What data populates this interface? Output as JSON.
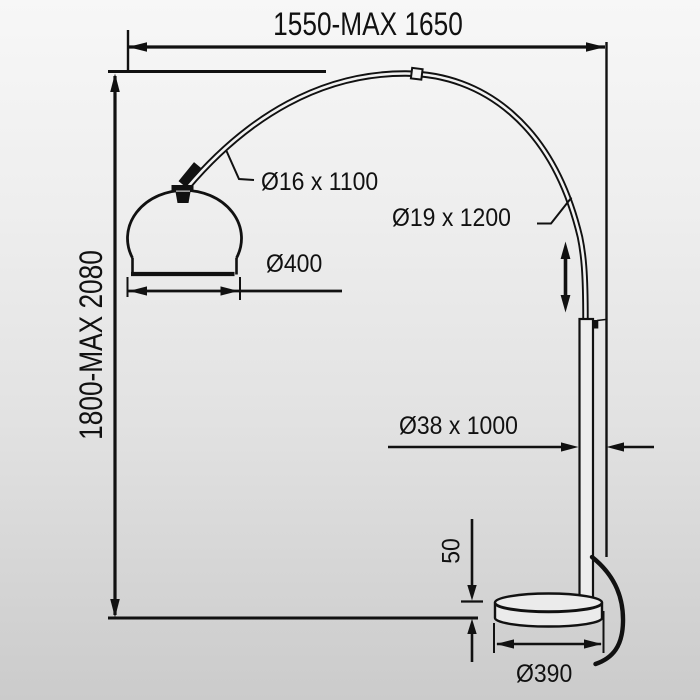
{
  "diagram": {
    "kind": "technical-dimension-drawing",
    "subject": "arc floor lamp"
  },
  "labels": {
    "width_range": "1550-MAX 1650",
    "height_range": "1800-MAX 2080",
    "arc_tube": "Ø16 x 1100",
    "upper_pole": "Ø19 x 1200",
    "main_pole": "Ø38 x 1000",
    "shade_diameter": "Ø400",
    "base_height": "50",
    "base_diameter": "Ø390"
  },
  "colors": {
    "line": "#111111",
    "background_top": "#f7f7f7",
    "background_bottom": "#cbcbcb",
    "fill_light": "#ebebeb"
  }
}
